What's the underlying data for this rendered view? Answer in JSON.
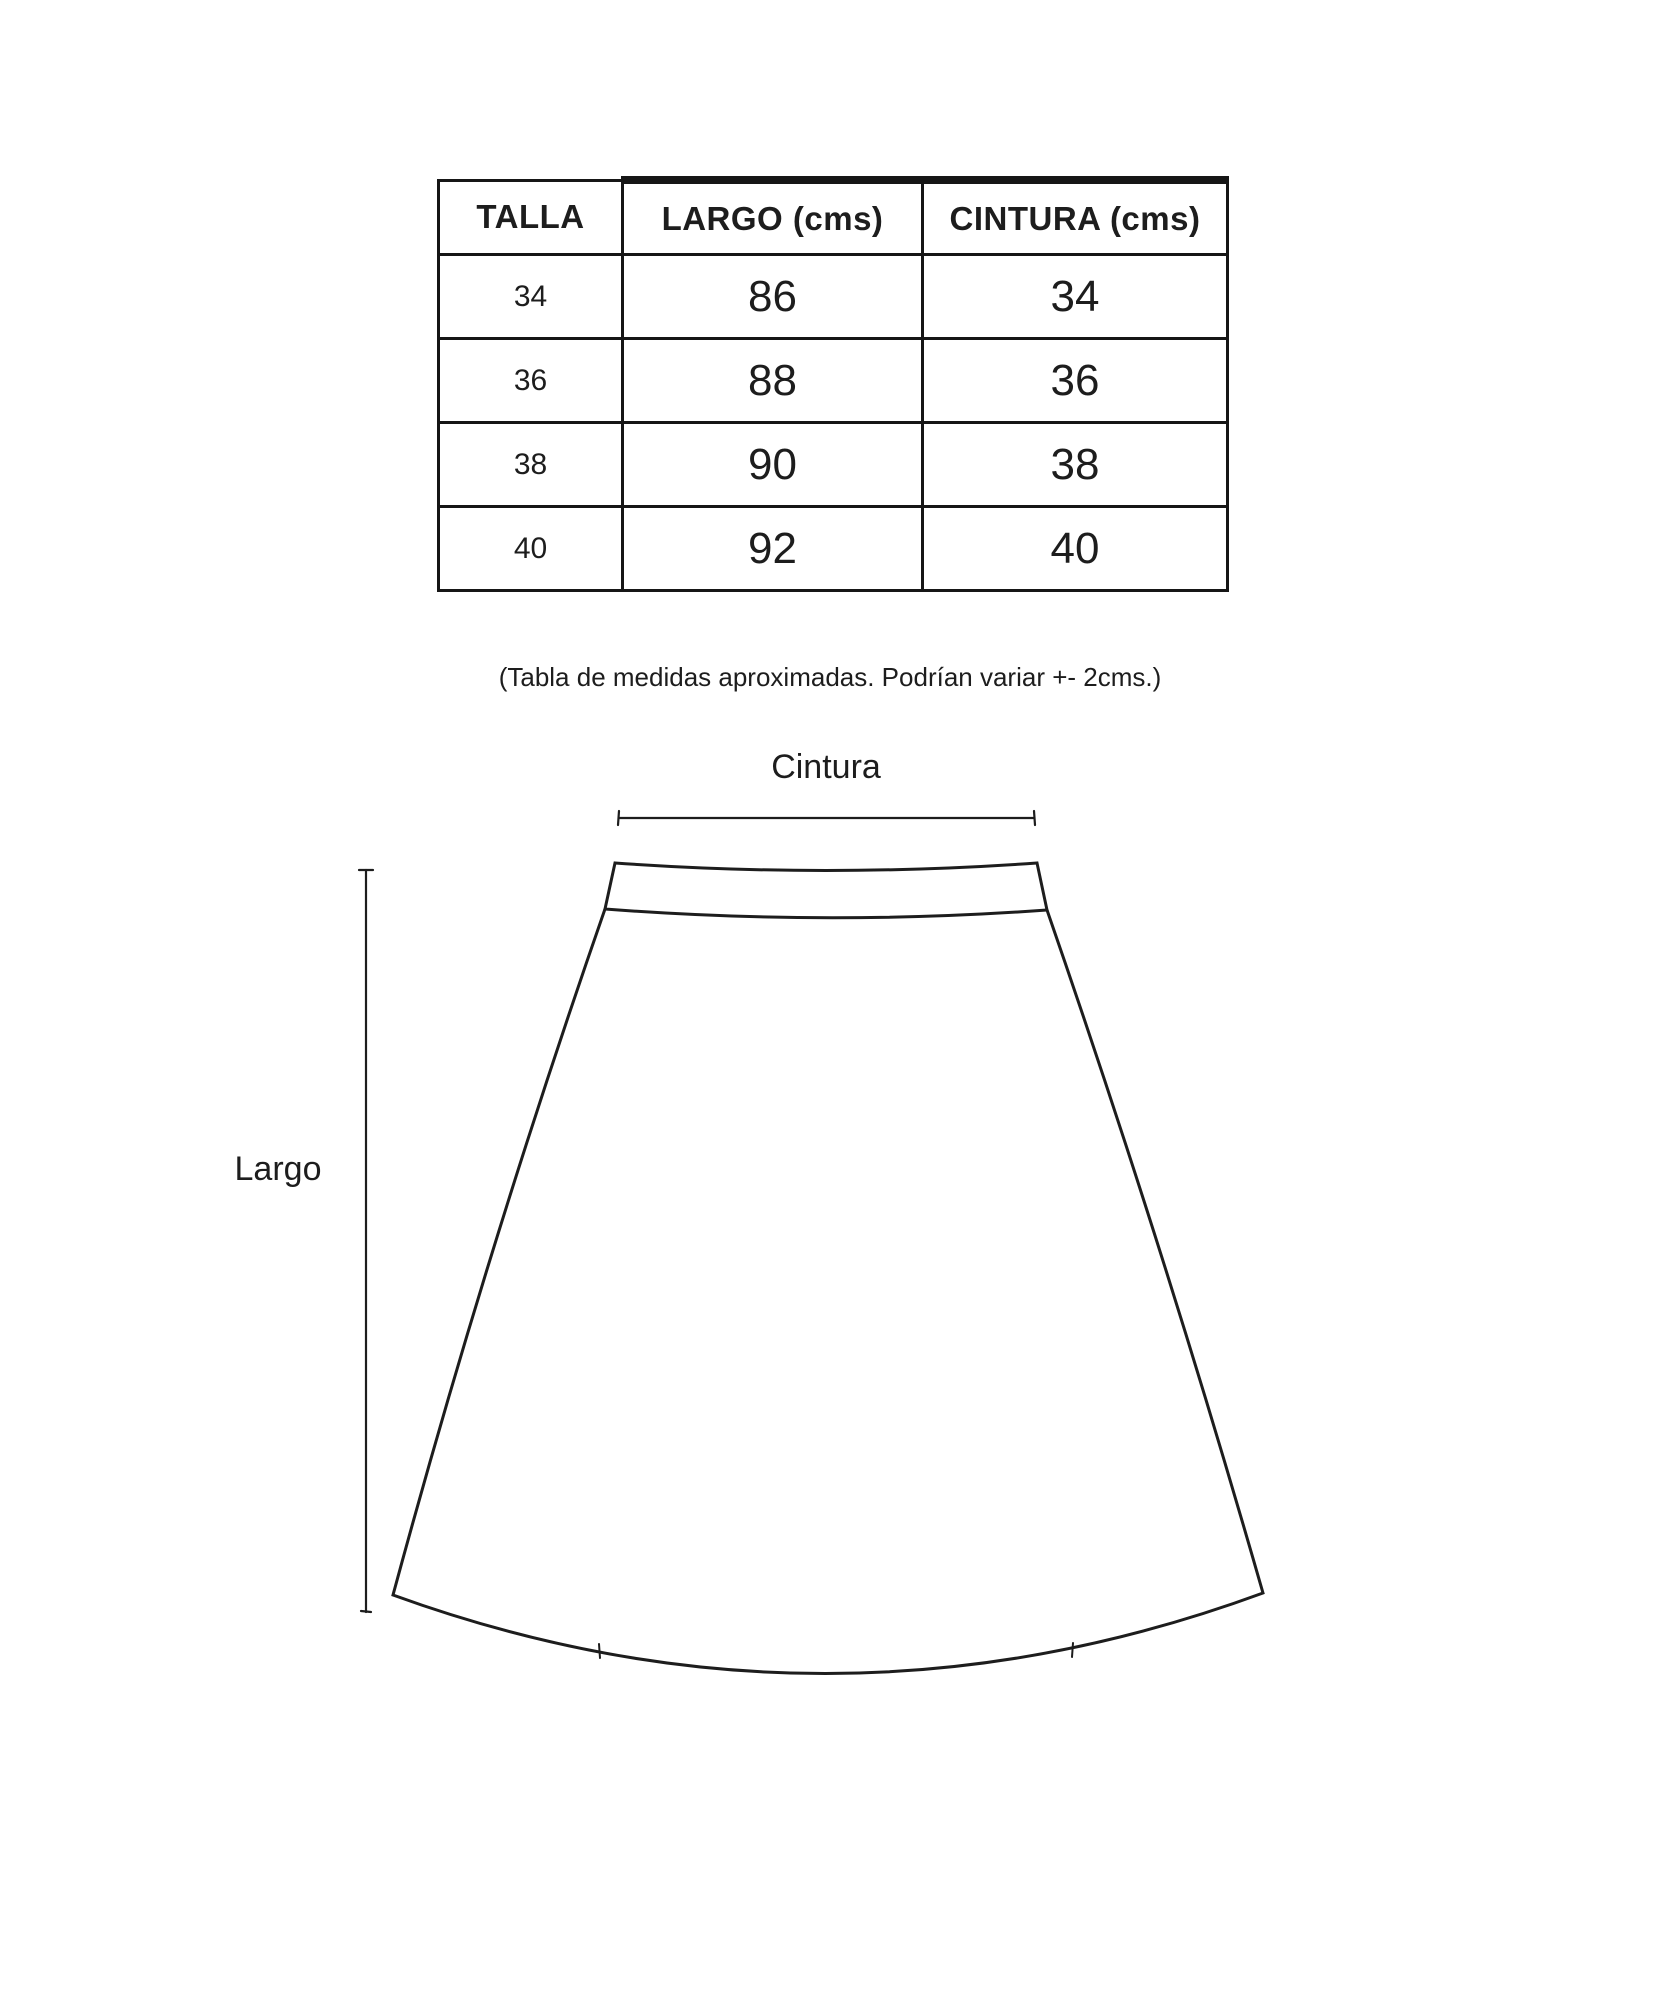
{
  "page": {
    "background_color": "#ffffff",
    "ink_color": "#1d1d1d"
  },
  "size_table": {
    "headers": [
      "TALLA",
      "LARGO (cms)",
      "CINTURA (cms)"
    ],
    "rows": [
      [
        "34",
        "86",
        "34"
      ],
      [
        "36",
        "88",
        "36"
      ],
      [
        "38",
        "90",
        "38"
      ],
      [
        "40",
        "92",
        "40"
      ]
    ]
  },
  "note": "(Tabla de medidas aproximadas. Podrían variar +- 2cms.)",
  "diagram": {
    "waist_label": "Cintura",
    "length_label": "Largo"
  }
}
